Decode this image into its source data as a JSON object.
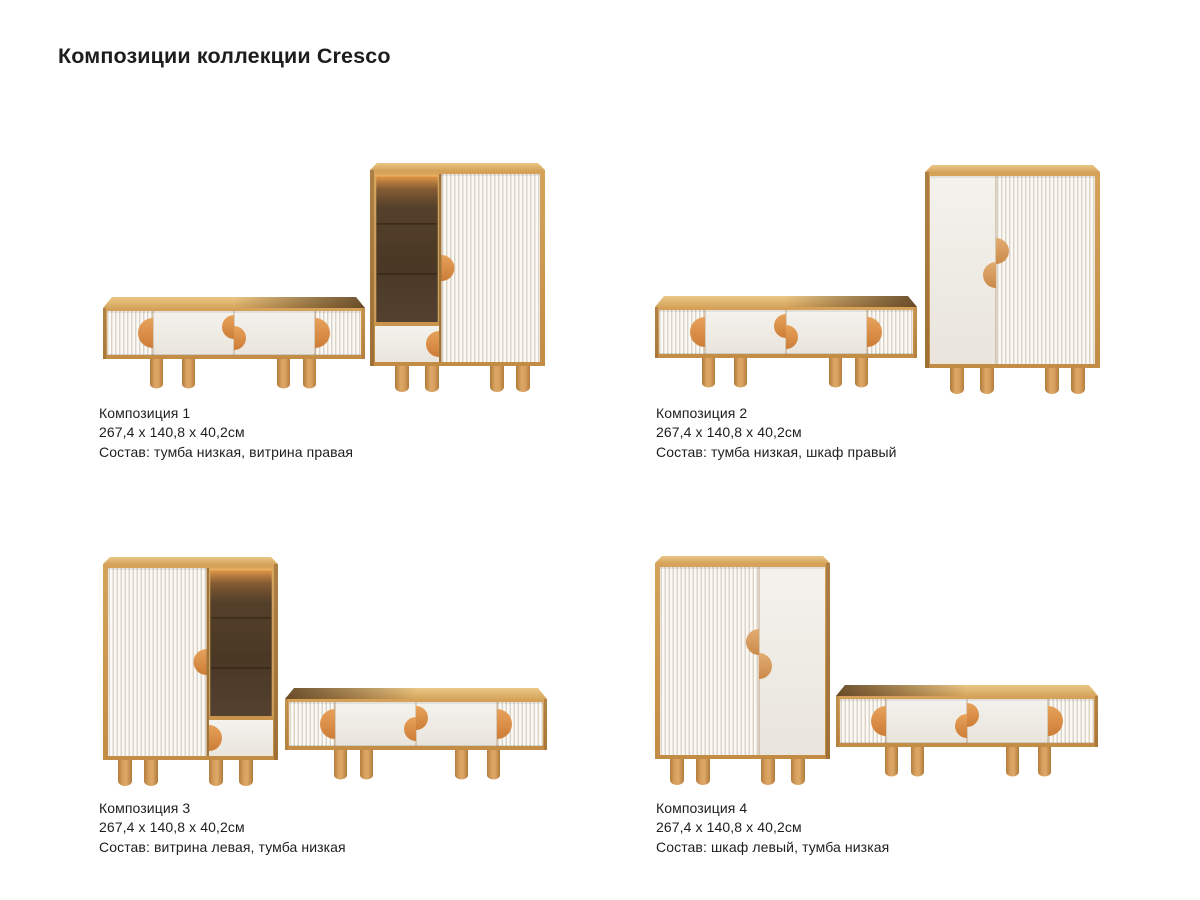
{
  "page_title": "Композиции коллекции Cresco",
  "compositions": [
    {
      "name": "Композиция 1",
      "dimensions": "267,4 x 140,8 x 40,2см",
      "contents": "Состав: тумба низкая, витрина правая"
    },
    {
      "name": "Композиция 2",
      "dimensions": "267,4 x 140,8 x 40,2см",
      "contents": "Состав: тумба низкая, шкаф правый"
    },
    {
      "name": "Композиция 3",
      "dimensions": "267,4 x 140,8 x 40,2см",
      "contents": "Состав: витрина левая, тумба низкая"
    },
    {
      "name": "Композиция 4",
      "dimensions": "267,4 x 140,8 x 40,2см",
      "contents": "Состав: шкаф левый, тумба низкая"
    }
  ],
  "colors": {
    "background": "#ffffff",
    "text": "#1e1e20",
    "wood": "#cc9750",
    "wood_top": "#ddb069",
    "handle_orange": "#d98c43",
    "door_white": "#f0eee8",
    "flute_groove": "#dbd3c6",
    "vitrine_interior": "#4e3b26",
    "vitrine_glow": "#f0a44e"
  }
}
